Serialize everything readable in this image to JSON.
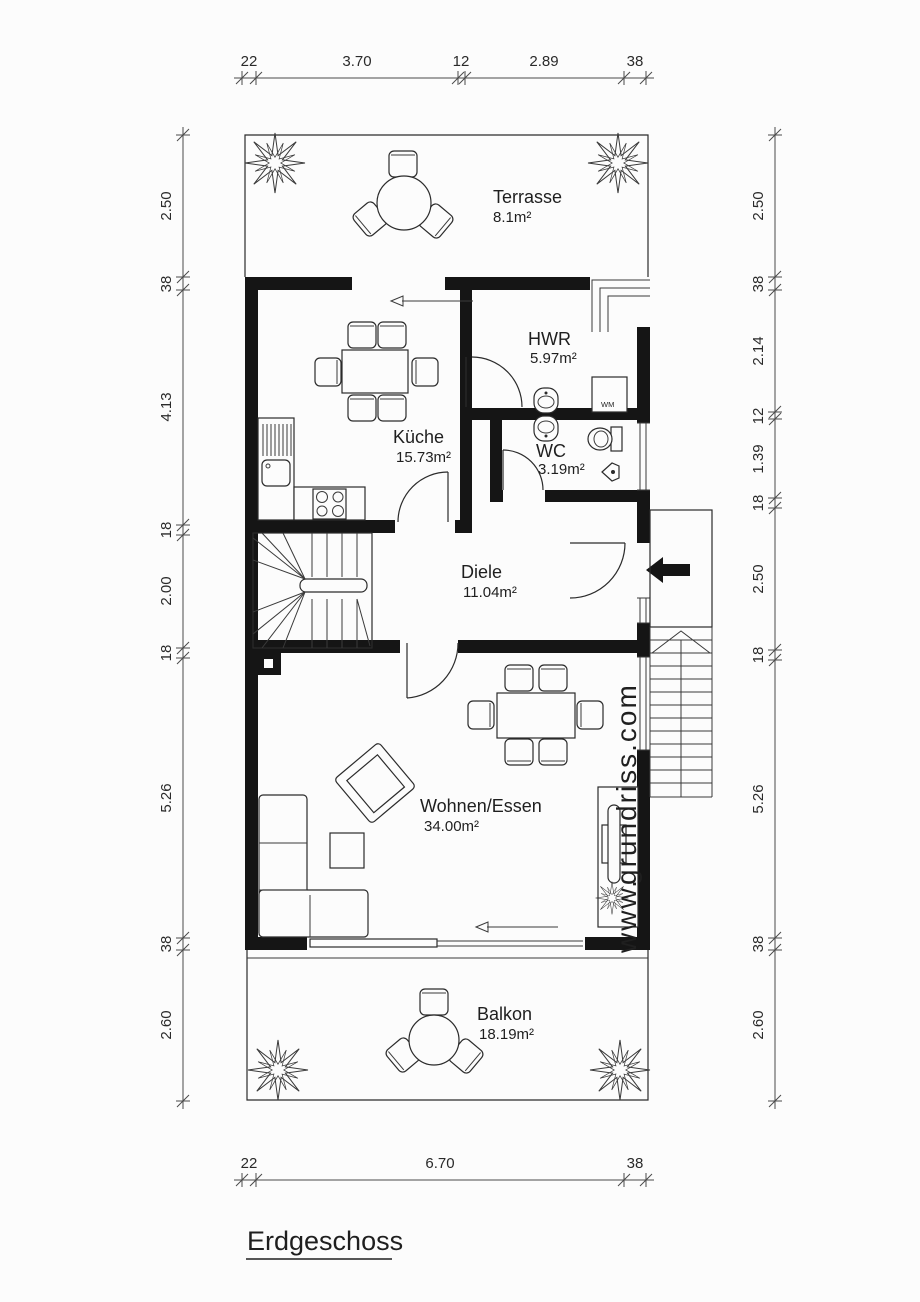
{
  "title": "Erdgeschoss",
  "watermark": {
    "prefix": "www.",
    "rest": "grundriss.com"
  },
  "rooms": [
    {
      "name": "Terrasse",
      "area": "8.1m²"
    },
    {
      "name": "HWR",
      "area": "5.97m²"
    },
    {
      "name": "Küche",
      "area": "15.73m²"
    },
    {
      "name": "WC",
      "area": "3.19m²"
    },
    {
      "name": "Diele",
      "area": "11.04m²"
    },
    {
      "name": "Wohnen/Essen",
      "area": "34.00m²"
    },
    {
      "name": "Balkon",
      "area": "18.19m²"
    }
  ],
  "appliances": {
    "washing_machine": "WM"
  },
  "dimensions": {
    "top": [
      "22",
      "3.70",
      "12",
      "2.89",
      "38"
    ],
    "bottom": [
      "22",
      "6.70",
      "38"
    ],
    "left": [
      "2.50",
      "38",
      "4.13",
      "18",
      "2.00",
      "18",
      "5.26",
      "38",
      "2.60"
    ],
    "right": [
      "2.50",
      "38",
      "2.14",
      "12",
      "1.39",
      "18",
      "2.50",
      "18",
      "5.26",
      "38",
      "2.60"
    ]
  },
  "colors": {
    "wall": "#151515",
    "line": "#2b2b2b",
    "background": "#fcfcfc",
    "watermark": "#8f8f8f"
  }
}
